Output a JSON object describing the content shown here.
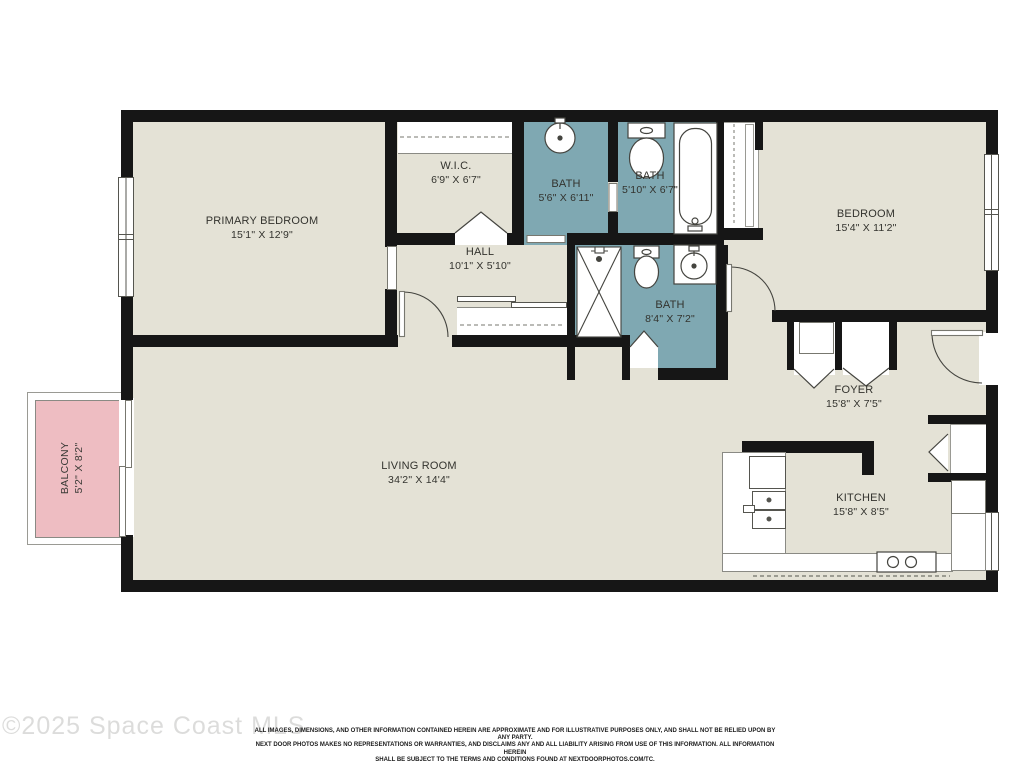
{
  "document": {
    "type": "residential-floor-plan"
  },
  "colors": {
    "wall": "#161616",
    "floor": "#e4e2d6",
    "bath_floor": "#7fa8b2",
    "balcony_floor": "#eebdc2",
    "fixture_line": "#55554f",
    "label_text": "#33332e"
  },
  "rooms": [
    {
      "id": "primary-bedroom",
      "name": "PRIMARY BEDROOM",
      "dims": "15'1\" X 12'9\""
    },
    {
      "id": "wic",
      "name": "W.I.C.",
      "dims": "6'9\" X 6'7\""
    },
    {
      "id": "bath-1",
      "name": "BATH",
      "dims": "5'6\" X 6'11\""
    },
    {
      "id": "bath-2",
      "name": "BATH",
      "dims": "5'10\" X 6'7\""
    },
    {
      "id": "hall",
      "name": "HALL",
      "dims": "10'1\" X 5'10\""
    },
    {
      "id": "bedroom",
      "name": "BEDROOM",
      "dims": "15'4\" X 11'2\""
    },
    {
      "id": "bath-3",
      "name": "BATH",
      "dims": "8'4\" X 7'2\""
    },
    {
      "id": "foyer",
      "name": "FOYER",
      "dims": "15'8\" X 7'5\""
    },
    {
      "id": "living-room",
      "name": "LIVING ROOM",
      "dims": "34'2\" X 14'4\""
    },
    {
      "id": "kitchen",
      "name": "KITCHEN",
      "dims": "15'8\" X 8'5\""
    },
    {
      "id": "balcony",
      "name": "BALCONY",
      "dims": "5'2\" X 8'2\""
    }
  ],
  "fixtures": [
    "round-sink-icon",
    "toilet-icon",
    "bathtub-icon",
    "shower-icon",
    "double-sink-icon",
    "dishwasher-icon",
    "stove-icon",
    "refrigerator-icon",
    "window",
    "door-swing-arc",
    "bifold-door",
    "sliding-door",
    "closet-rod-dashed"
  ],
  "footer": {
    "watermark": "©2025 Space Coast MLS",
    "disclaimer": [
      "ALL IMAGES, DIMENSIONS, AND OTHER INFORMATION CONTAINED HEREIN ARE APPROXIMATE AND FOR ILLUSTRATIVE PURPOSES ONLY, AND SHALL NOT BE RELIED UPON BY ANY PARTY.",
      "NEXT DOOR PHOTOS MAKES NO REPRESENTATIONS OR WARRANTIES, AND DISCLAIMS ANY AND ALL LIABILITY ARISING FROM USE OF THIS INFORMATION. ALL INFORMATION HEREIN",
      "SHALL BE SUBJECT TO THE TERMS AND CONDITIONS FOUND AT NEXTDOORPHOTOS.COM/TC."
    ]
  }
}
